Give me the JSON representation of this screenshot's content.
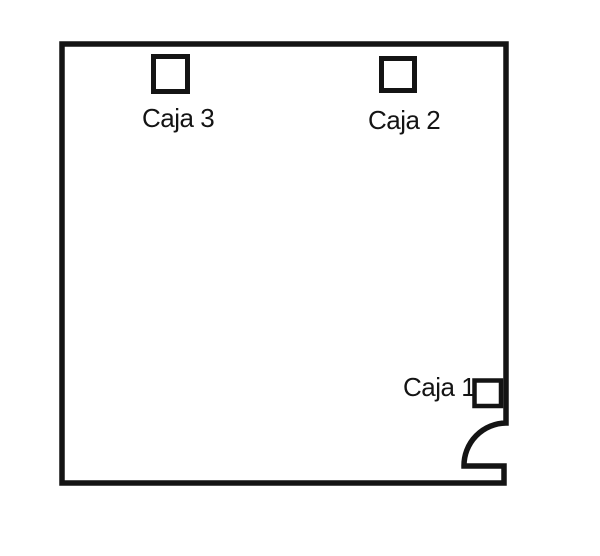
{
  "diagram": {
    "background_color": "#ffffff",
    "line_color": "#141414",
    "room": {
      "shape": "square-room-outline",
      "door": {
        "name": "door-swing-arc",
        "position": "bottom-right-of-right-wall"
      }
    },
    "boxes": [
      {
        "id": "caja-3",
        "label": "Caja 3",
        "position": "inside-top-left"
      },
      {
        "id": "caja-2",
        "label": "Caja 2",
        "position": "inside-top-right"
      },
      {
        "id": "caja-1",
        "label": "Caja 1",
        "position": "inside-bottom-right-next-to-door"
      }
    ]
  }
}
